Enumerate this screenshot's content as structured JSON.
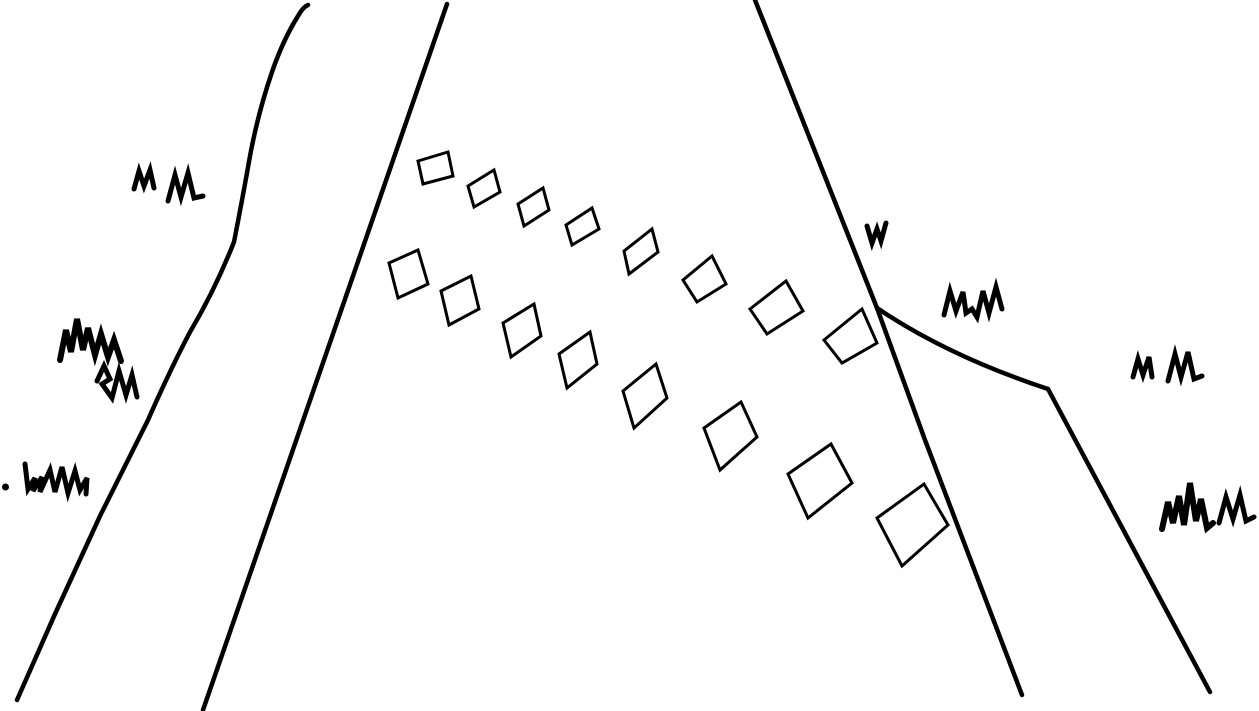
{
  "scene": {
    "description": "hand-drawn black-and-white sketch of a road in perspective with dashed lane markings and grass tufts",
    "background_color": "#ffffff",
    "ink_color": "#000000",
    "canvas": {
      "width": 1259,
      "height": 711
    }
  },
  "road": {
    "edge_stroke_width": 4.5,
    "edges": [
      {
        "name": "left-outer-road-edge-line",
        "d": "M308,5 Q303,7 298,16 Q283,40 272,72 Q258,113 250,156 Q243,196 234,242 Q215,290 190,332 Q170,370 148,420 L100,516 L55,614 L17,700"
      },
      {
        "name": "left-inner-road-edge-line",
        "d": "M447,4 L203,710"
      },
      {
        "name": "right-main-road-edge-line",
        "d": "M755,0 L877,308 L925,440 L1022,695"
      },
      {
        "name": "right-branch-curve",
        "d": "M877,308 Q948,356 1048,389"
      },
      {
        "name": "right-outer-road-edge-line",
        "d": "M1048,389 L1210,692"
      }
    ]
  },
  "lane_markings": {
    "stroke_width": 3,
    "rows": [
      {
        "name": "upper-dash-row",
        "squares": [
          [
            418,
            161,
            448,
            152,
            453,
            176,
            423,
            184
          ],
          [
            468,
            186,
            494,
            170,
            500,
            192,
            474,
            207
          ],
          [
            518,
            204,
            543,
            188,
            549,
            210,
            524,
            226
          ],
          [
            566,
            225,
            592,
            208,
            599,
            229,
            572,
            245
          ],
          [
            624,
            251,
            652,
            229,
            658,
            252,
            629,
            274
          ],
          [
            683,
            280,
            712,
            256,
            726,
            284,
            697,
            302
          ],
          [
            750,
            309,
            786,
            281,
            803,
            311,
            767,
            334
          ],
          [
            824,
            340,
            862,
            309,
            877,
            343,
            842,
            363
          ]
        ]
      },
      {
        "name": "lower-dash-row",
        "squares": [
          [
            389,
            263,
            418,
            250,
            428,
            284,
            398,
            298
          ],
          [
            441,
            291,
            471,
            276,
            479,
            309,
            449,
            325
          ],
          [
            503,
            323,
            534,
            304,
            541,
            336,
            511,
            357
          ],
          [
            559,
            354,
            590,
            332,
            597,
            364,
            567,
            388
          ],
          [
            623,
            391,
            656,
            364,
            667,
            398,
            634,
            428
          ],
          [
            704,
            428,
            741,
            402,
            757,
            437,
            720,
            470
          ],
          [
            788,
            474,
            831,
            444,
            852,
            483,
            808,
            518
          ],
          [
            877,
            518,
            924,
            484,
            948,
            525,
            902,
            566
          ]
        ]
      }
    ]
  },
  "grass_tufts": [
    {
      "name": "grass-tuft-top-left-small",
      "width": 5,
      "fill": "none",
      "d": "M134,189 L139,171 L144,186 L150,170 L154,188"
    },
    {
      "name": "grass-tuft-top-left-large",
      "width": 5,
      "fill": "none",
      "d": "M168,201 L175,175 L181,197 L188,173 L194,198 L203,196"
    },
    {
      "name": "grass-tuft-left-clump-upper",
      "width": 6,
      "fill": "none",
      "d": "M60,360 L66,330 L71,352 L77,319 L83,350 L88,328 L95,355 L101,334 L108,357 L114,340 L121,361"
    },
    {
      "name": "grass-tuft-left-clump-lower",
      "width": 5,
      "fill": "none",
      "d": "M97,381 L104,366 L110,379 L102,384 L112,398 L119,371 L126,395 L132,375 L137,397"
    },
    {
      "name": "grass-tuft-left-edge-dot",
      "width": 0,
      "fill": "#000000",
      "d": "M2,487 a3.5,3.5 0 1 0 7,0 a3.5,3.5 0 1 0 -7,0"
    },
    {
      "name": "grass-tuft-left-edge-zigzag",
      "width": 5,
      "fill": "none",
      "d": "M25,464 L28,489 L35,478 L33,491 L42,477 L40,492 L50,470 L55,492 L62,467 L68,493 L75,471 L80,490 L87,478 L86,494"
    },
    {
      "name": "grass-tuft-mid-right-small",
      "width": 5,
      "fill": "none",
      "d": "M867,226 L872,243 L877,229 L881,241 L886,223"
    },
    {
      "name": "grass-tuft-right-of-fork",
      "width": 5,
      "fill": "none",
      "d": "M944,315 L950,291 L956,311 L963,292 L966,313 L972,309 L977,317 L983,291 L989,313 L996,287 L1002,309"
    },
    {
      "name": "grass-tuft-far-right-small",
      "width": 5,
      "fill": "none",
      "d": "M1133,377 L1138,359 L1143,375 L1149,357 L1152,377"
    },
    {
      "name": "grass-tuft-far-right-large",
      "width": 5,
      "fill": "none",
      "d": "M1168,381 L1175,354 L1181,377 L1188,352 L1194,379 L1202,376"
    },
    {
      "name": "grass-tuft-bottom-right-clump",
      "width": 6,
      "fill": "none",
      "d": "M1162,529 L1168,502 L1173,523 L1179,496 L1184,525 L1190,483 L1196,521 L1201,499 L1207,528 L1213,523"
    },
    {
      "name": "grass-tuft-bottom-right-small",
      "width": 5,
      "fill": "none",
      "d": "M1219,523 L1226,497 L1233,519 L1240,495 L1246,521 L1254,517"
    }
  ]
}
